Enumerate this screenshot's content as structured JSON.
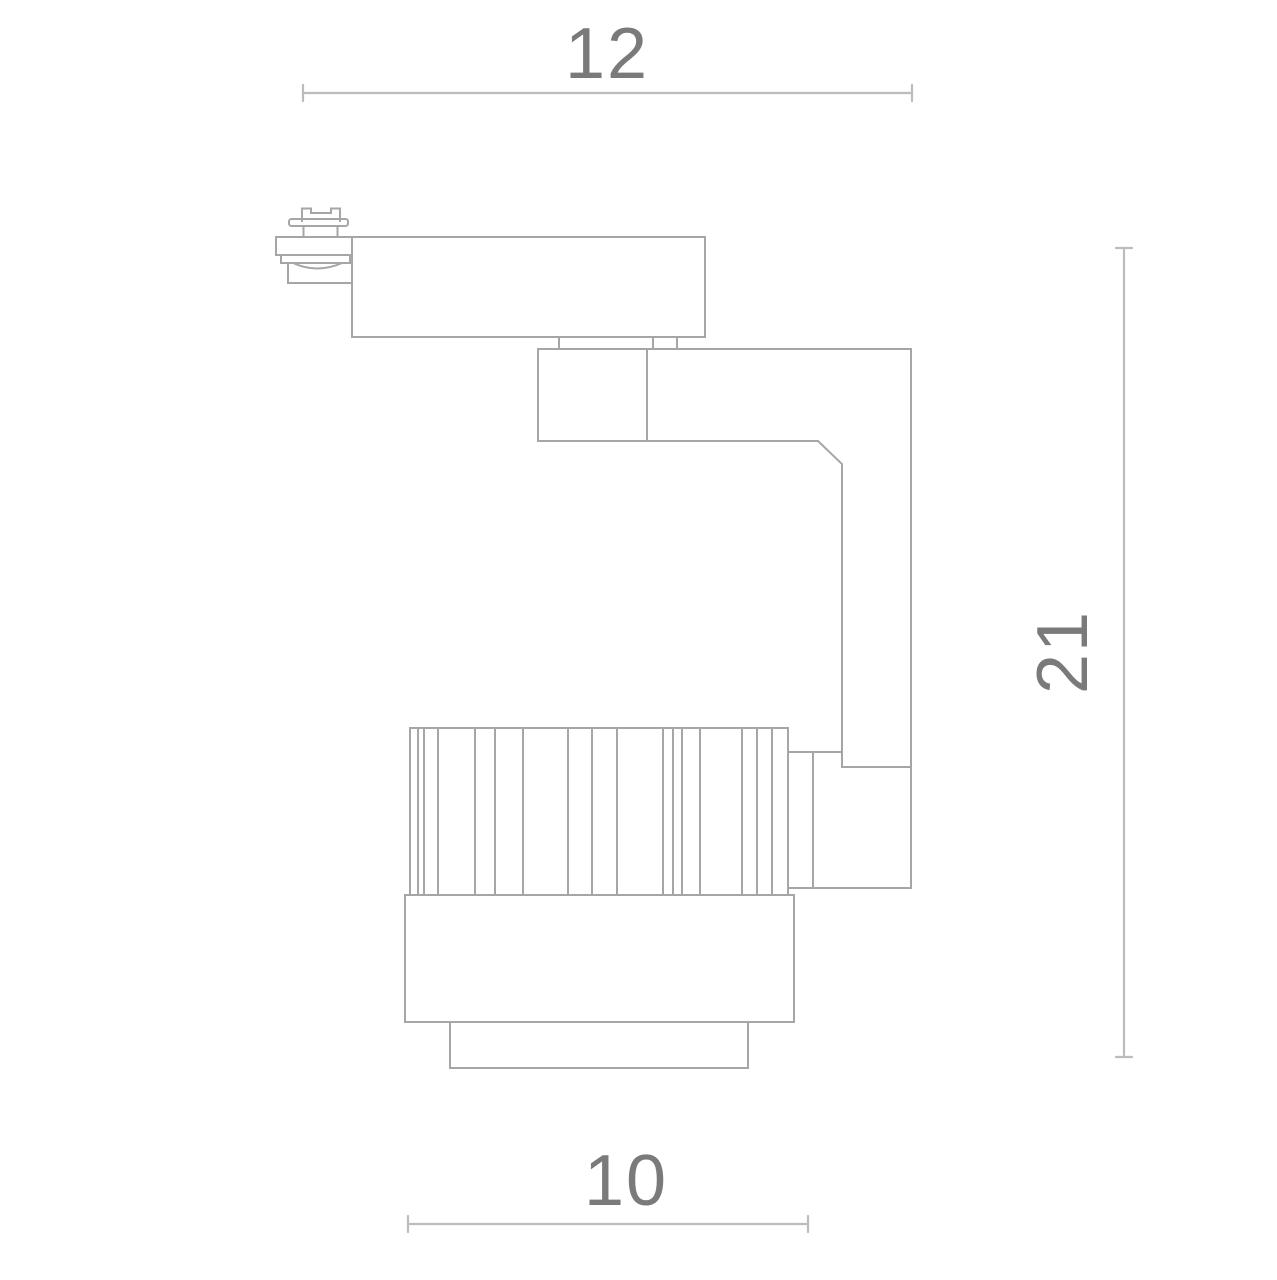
{
  "colors": {
    "background": "#ffffff",
    "outline": "#a6a6a6",
    "dimension_line": "#bcbcbc",
    "label_text": "#7a7a7a"
  },
  "dimensions": {
    "top": {
      "label": "12",
      "line": {
        "x1": 303,
        "y1": 93,
        "x2": 912,
        "y2": 93
      },
      "label_pos": {
        "x": 607,
        "y": 78
      },
      "rotated": false
    },
    "right": {
      "label": "21",
      "line": {
        "x1": 1124,
        "y1": 248,
        "x2": 1124,
        "y2": 1057
      },
      "label_pos": {
        "x": 1062,
        "y": 652
      },
      "rotated": true
    },
    "bottom": {
      "label": "10",
      "line": {
        "x1": 408,
        "y1": 1224,
        "x2": 808,
        "y2": 1224
      },
      "label_pos": {
        "x": 626,
        "y": 1205
      },
      "rotated": false
    }
  },
  "drawing": {
    "tick_half_length": 8,
    "parts": [
      {
        "name": "track-contact-pin",
        "type": "path",
        "d": "M302,221 L302,208.5 L311,208.5 L311,213 L331,213 L331,208.5 L340,208.5 L340,221"
      },
      {
        "name": "contact-flange",
        "type": "rect",
        "x": 289,
        "y": 219,
        "w": 59,
        "h": 7,
        "rx": 2.5
      },
      {
        "name": "contact-post-left",
        "type": "line",
        "x1": 303.5,
        "y1": 226,
        "x2": 303.5,
        "y2": 237
      },
      {
        "name": "contact-post-right",
        "type": "line",
        "x1": 337.5,
        "y1": 226,
        "x2": 337.5,
        "y2": 237
      },
      {
        "name": "adapter-upper-body",
        "type": "rect",
        "x": 276,
        "y": 237,
        "w": 76,
        "h": 18
      },
      {
        "name": "adapter-mid-plate",
        "type": "rect",
        "x": 281,
        "y": 255,
        "w": 69,
        "h": 8
      },
      {
        "name": "adapter-lens-dome",
        "type": "path",
        "d": "M293,263 Q317,274 342,263"
      },
      {
        "name": "adapter-lower-block",
        "type": "rect",
        "x": 288,
        "y": 263,
        "w": 64,
        "h": 20
      },
      {
        "name": "track-mount-body",
        "type": "rect",
        "x": 352,
        "y": 237,
        "w": 353,
        "h": 100
      },
      {
        "name": "neck-stub-left",
        "type": "line",
        "x1": 559,
        "y1": 337,
        "x2": 559,
        "y2": 349
      },
      {
        "name": "neck-stub-mid",
        "type": "line",
        "x1": 653,
        "y1": 337,
        "x2": 653,
        "y2": 349
      },
      {
        "name": "neck-stub-right",
        "type": "line",
        "x1": 677,
        "y1": 337,
        "x2": 677,
        "y2": 349
      },
      {
        "name": "hinge-block",
        "type": "rect",
        "x": 538,
        "y": 349,
        "w": 109,
        "h": 92
      },
      {
        "name": "arm-top-edge",
        "type": "line",
        "x1": 647,
        "y1": 349,
        "x2": 911,
        "y2": 349
      },
      {
        "name": "arm-outer-edge",
        "type": "line",
        "x1": 911,
        "y1": 349,
        "x2": 911,
        "y2": 888
      },
      {
        "name": "arm-inner-edge",
        "type": "path",
        "d": "M647,441 L818,441 L842,464 L842,767 L911,767"
      },
      {
        "name": "mount-block-top",
        "type": "line",
        "x1": 788,
        "y1": 752,
        "x2": 842,
        "y2": 752
      },
      {
        "name": "mount-block-left",
        "type": "line",
        "x1": 813,
        "y1": 752,
        "x2": 813,
        "y2": 888
      },
      {
        "name": "mount-block-bottom",
        "type": "line",
        "x1": 788,
        "y1": 888,
        "x2": 911,
        "y2": 888
      },
      {
        "name": "heatsink-top-edge",
        "type": "line",
        "x1": 410,
        "y1": 728,
        "x2": 788,
        "y2": 728
      },
      {
        "name": "heatsink-fins",
        "type": "ribs",
        "y1": 728,
        "y2": 895,
        "x": [
          410,
          418,
          424,
          438,
          475,
          495,
          523,
          568,
          592,
          617,
          663,
          673,
          682,
          700,
          742,
          757,
          772,
          788
        ]
      },
      {
        "name": "lamp-body",
        "type": "rect",
        "x": 405,
        "y": 895,
        "w": 389,
        "h": 127
      },
      {
        "name": "front-bezel",
        "type": "rect",
        "x": 450,
        "y": 1022,
        "w": 298,
        "h": 46
      }
    ]
  }
}
